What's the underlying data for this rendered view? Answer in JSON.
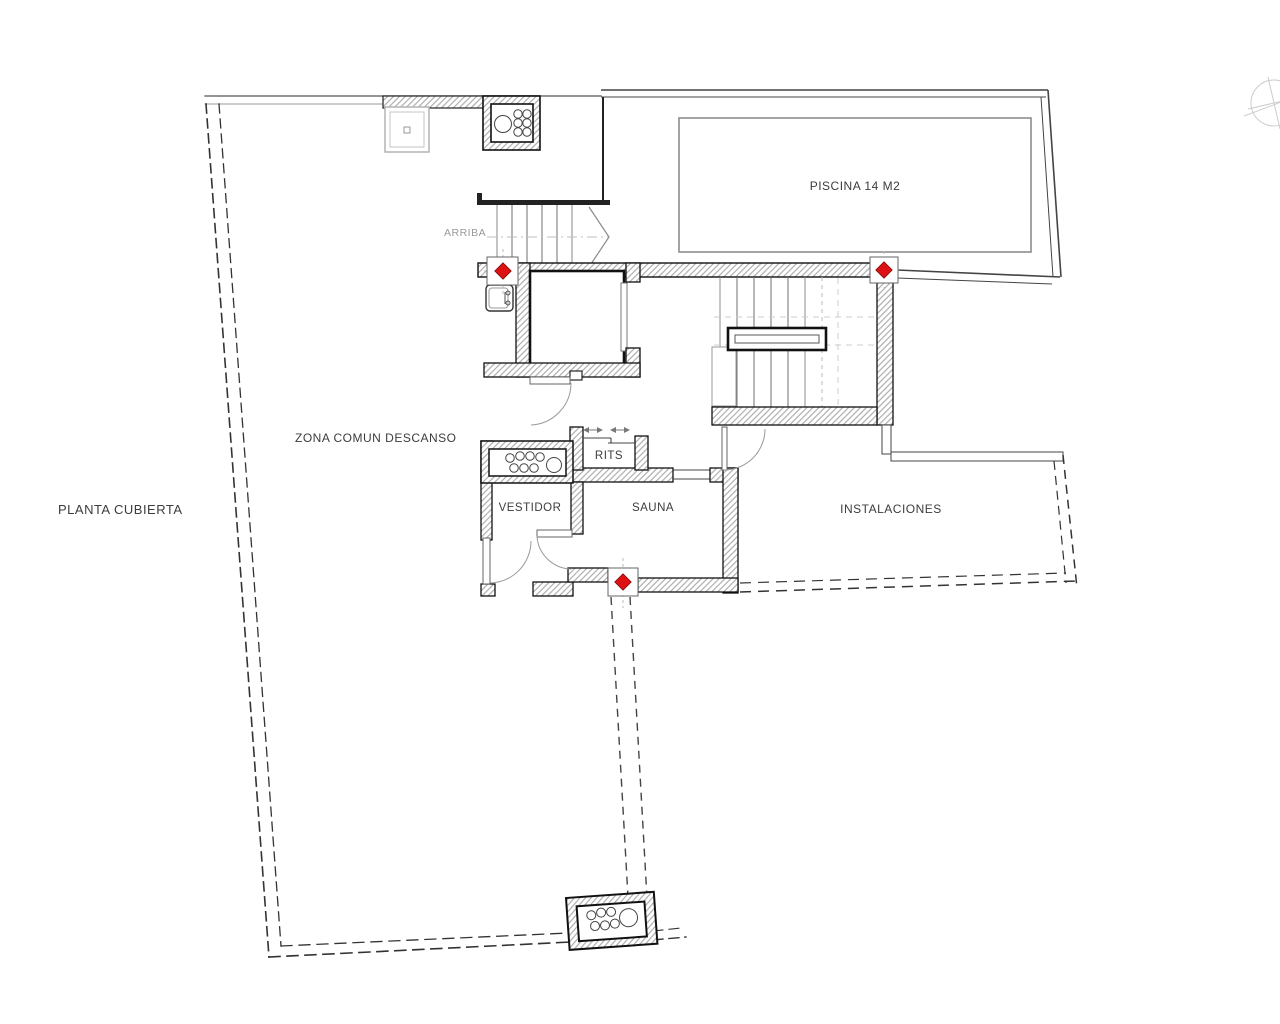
{
  "plan": {
    "title": "PLANTA CUBIERTA",
    "areas": {
      "zona_comun": "ZONA COMUN DESCANSO",
      "piscina": "PISCINA 14 M2",
      "rits": "RITS",
      "vestidor": "VESTIDOR",
      "sauna": "SAUNA",
      "instalaciones": "INSTALACIONES"
    },
    "stair_note": "ARRIBA",
    "marker_color": "#de1212",
    "marker_count": 3,
    "hatch_color": "#a8a8a8",
    "line_color": "#1a1a1a"
  }
}
